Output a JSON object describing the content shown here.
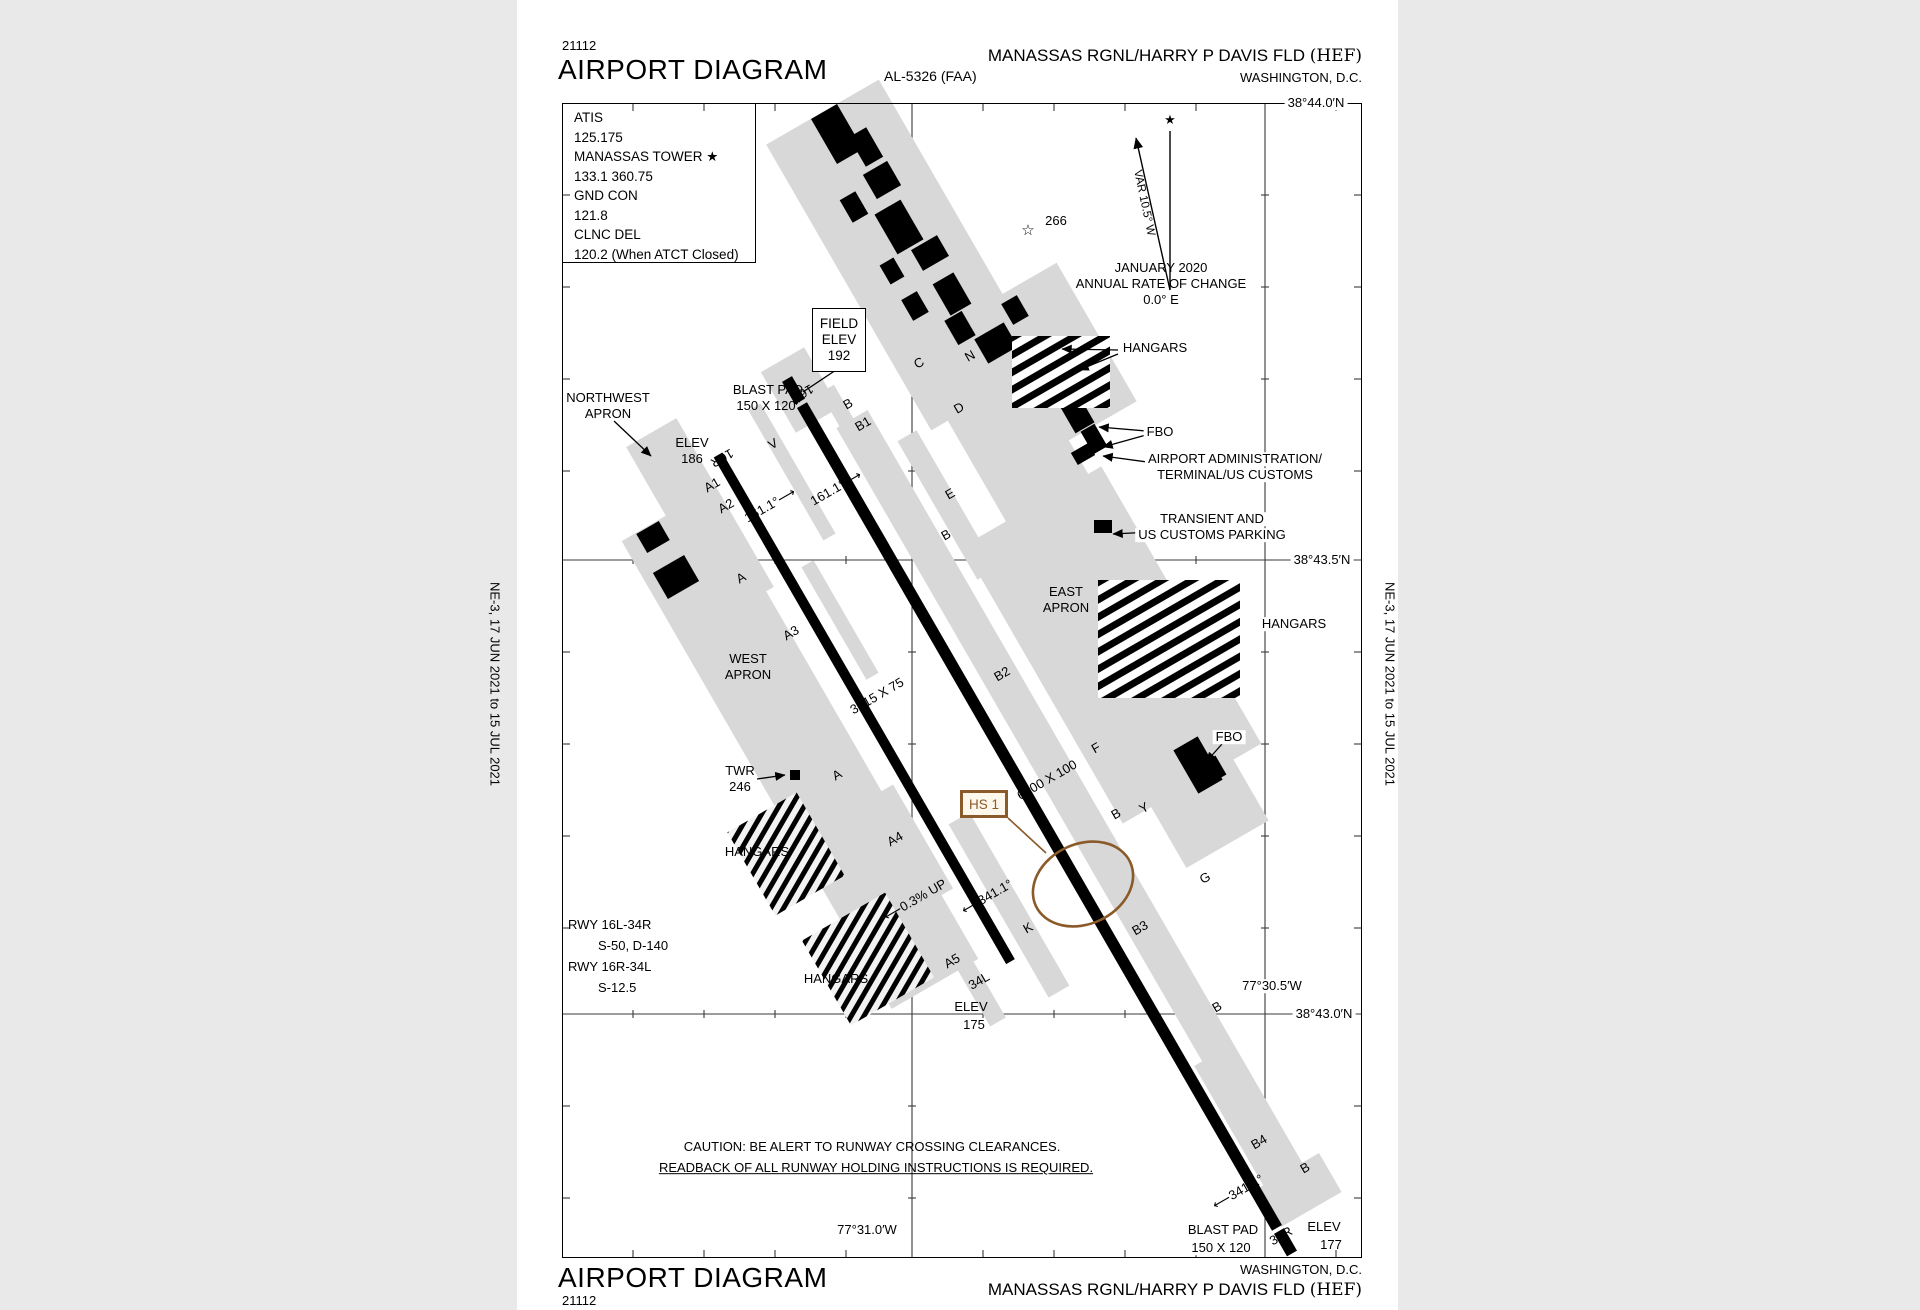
{
  "header": {
    "chart_id": "21112",
    "title": "AIRPORT DIAGRAM",
    "procedure_id": "AL-5326 (FAA)",
    "airport_name": "MANASSAS RGNL/HARRY P DAVIS FLD ",
    "airport_code": "(HEF)",
    "city": "WASHINGTON, D.C."
  },
  "footer": {
    "chart_id": "21112",
    "title": "AIRPORT DIAGRAM",
    "airport_name": "MANASSAS RGNL/HARRY P DAVIS FLD ",
    "airport_code": "(HEF)",
    "city": "WASHINGTON, D.C."
  },
  "margins": {
    "left_note": "NE-3,  17 JUN 2021  to  15 JUL 2021",
    "right_note": "NE-3,  17 JUN 2021  to  15 JUL 2021"
  },
  "comm_box": {
    "lines": [
      "ATIS",
      "125.175",
      "MANASSAS TOWER ★",
      "133.1  360.75",
      "GND CON",
      "121.8",
      "CLNC DEL",
      "120.2 (When ATCT Closed)"
    ]
  },
  "field_elev_box": {
    "lines": [
      "FIELD",
      "ELEV",
      "192"
    ]
  },
  "hot_spot": {
    "label": "HS 1"
  },
  "colors": {
    "hotspot_brown": "#8a5a2a",
    "apron_gray": "#d8d8d8",
    "ink": "#000000",
    "page": "#ffffff"
  },
  "labels": [
    {
      "n": "lat-label-44-0",
      "t": "38°44.0′N",
      "x": 1316,
      "y": 103,
      "cls": "bg"
    },
    {
      "n": "lat-label-43-5",
      "t": "38°43.5′N",
      "x": 1322,
      "y": 560,
      "cls": "bg"
    },
    {
      "n": "lat-label-43-0",
      "t": "38°43.0′N",
      "x": 1324,
      "y": 1014,
      "cls": "bg"
    },
    {
      "n": "lon-label-30-5",
      "t": "77°30.5′W",
      "x": 1272,
      "y": 986,
      "cls": "bg"
    },
    {
      "n": "lon-label-31-0",
      "t": "77°31.0′W",
      "x": 867,
      "y": 1230,
      "cls": "bg"
    },
    {
      "n": "magvar-date",
      "t": "JANUARY 2020",
      "x": 1161,
      "y": 268
    },
    {
      "n": "magvar-rate-1",
      "t": "ANNUAL RATE OF CHANGE",
      "x": 1161,
      "y": 284
    },
    {
      "n": "magvar-rate-2",
      "t": "0.0° E",
      "x": 1161,
      "y": 300
    },
    {
      "n": "beacon-star-icon",
      "t": "☆",
      "x": 1028,
      "y": 231,
      "fs": 15
    },
    {
      "n": "beacon-elev",
      "t": "266",
      "x": 1056,
      "y": 221
    },
    {
      "n": "hangars-north-label",
      "t": "HANGARS",
      "x": 1155,
      "y": 348,
      "cls": "bg"
    },
    {
      "n": "fbo-north-label",
      "t": "FBO",
      "x": 1160,
      "y": 432,
      "cls": "bg"
    },
    {
      "n": "admin-label-1",
      "t": "AIRPORT ADMINISTRATION/",
      "x": 1235,
      "y": 459,
      "cls": "bg"
    },
    {
      "n": "admin-label-2",
      "t": "TERMINAL/US CUSTOMS",
      "x": 1235,
      "y": 475,
      "cls": "bg"
    },
    {
      "n": "transient-label-1",
      "t": "TRANSIENT AND",
      "x": 1212,
      "y": 519,
      "cls": "bg"
    },
    {
      "n": "transient-label-2",
      "t": "US CUSTOMS PARKING",
      "x": 1212,
      "y": 535,
      "cls": "bg"
    },
    {
      "n": "east-apron-label-1",
      "t": "EAST",
      "x": 1066,
      "y": 592
    },
    {
      "n": "east-apron-label-2",
      "t": "APRON",
      "x": 1066,
      "y": 608
    },
    {
      "n": "hangars-east-label",
      "t": "HANGARS",
      "x": 1294,
      "y": 624,
      "cls": "bg"
    },
    {
      "n": "fbo-south-label",
      "t": "FBO",
      "x": 1229,
      "y": 737,
      "cls": "bg"
    },
    {
      "n": "northwest-apron-label-1",
      "t": "NORTHWEST",
      "x": 608,
      "y": 398
    },
    {
      "n": "northwest-apron-label-2",
      "t": "APRON",
      "x": 608,
      "y": 414
    },
    {
      "n": "elev-186-label-1",
      "t": "ELEV",
      "x": 692,
      "y": 443
    },
    {
      "n": "elev-186-label-2",
      "t": "186",
      "x": 692,
      "y": 459
    },
    {
      "n": "blastpad-north-label-1",
      "t": "BLAST PAD",
      "x": 768,
      "y": 390
    },
    {
      "n": "blastpad-north-label-2",
      "t": "150 X 120",
      "x": 766,
      "y": 406
    },
    {
      "n": "west-apron-label-1",
      "t": "WEST",
      "x": 748,
      "y": 659
    },
    {
      "n": "west-apron-label-2",
      "t": "APRON",
      "x": 748,
      "y": 675
    },
    {
      "n": "tower-label-1",
      "t": "TWR",
      "x": 740,
      "y": 771
    },
    {
      "n": "tower-label-2",
      "t": "246",
      "x": 740,
      "y": 787
    },
    {
      "n": "hangars-west-label",
      "t": "HANGARS",
      "x": 757,
      "y": 852
    },
    {
      "n": "hangars-southwest-label",
      "t": "HANGARS",
      "x": 836,
      "y": 979
    },
    {
      "n": "rwy-data-1",
      "t": "RWY 16L-34R",
      "x": 568,
      "y": 925,
      "cls": "left"
    },
    {
      "n": "rwy-data-2",
      "t": "S-50, D-140",
      "x": 598,
      "y": 946,
      "cls": "left"
    },
    {
      "n": "rwy-data-3",
      "t": "RWY 16R-34L",
      "x": 568,
      "y": 967,
      "cls": "left"
    },
    {
      "n": "rwy-data-4",
      "t": "S-12.5",
      "x": 598,
      "y": 988,
      "cls": "left"
    },
    {
      "n": "caution-line-1",
      "t": "CAUTION: BE ALERT TO RUNWAY CROSSING CLEARANCES.",
      "x": 872,
      "y": 1147
    },
    {
      "n": "caution-line-2",
      "t": "READBACK OF ALL RUNWAY HOLDING INSTRUCTIONS IS REQUIRED.",
      "x": 876,
      "y": 1168,
      "cls": "ul"
    },
    {
      "n": "blastpad-south-label-1",
      "t": "BLAST PAD",
      "x": 1223,
      "y": 1230,
      "cls": "bg"
    },
    {
      "n": "blastpad-south-label-2",
      "t": "150 X 120",
      "x": 1221,
      "y": 1248,
      "cls": "bg"
    },
    {
      "n": "elev-177-label-1",
      "t": "ELEV",
      "x": 1324,
      "y": 1227
    },
    {
      "n": "elev-177-label-2",
      "t": "177",
      "x": 1331,
      "y": 1245
    },
    {
      "n": "elev-175-label-1",
      "t": "ELEV",
      "x": 971,
      "y": 1007
    },
    {
      "n": "elev-175-label-2",
      "t": "175",
      "x": 974,
      "y": 1025
    },
    {
      "n": "rwy-16l-number",
      "t": "16L",
      "x": 803,
      "y": 393,
      "rot": 150
    },
    {
      "n": "rwy-16r-number",
      "t": "16R",
      "x": 722,
      "y": 458,
      "rot": 150
    },
    {
      "n": "rwy-34l-number",
      "t": "34L",
      "x": 979,
      "y": 981,
      "rot": -30
    },
    {
      "n": "rwy-34r-number",
      "t": "34R",
      "x": 1281,
      "y": 1236,
      "rot": -30
    },
    {
      "n": "rwy-heading-161-west",
      "t": "161.1°⟶",
      "x": 770,
      "y": 505,
      "rot": -30
    },
    {
      "n": "rwy-heading-161-east",
      "t": "161.1°⟶",
      "x": 836,
      "y": 488,
      "rot": -30
    },
    {
      "n": "rwy-heading-341-east",
      "t": "⟵341.1°",
      "x": 1238,
      "y": 1192,
      "rot": -30
    },
    {
      "n": "rwy-heading-341-west",
      "t": "⟵341.1°",
      "x": 987,
      "y": 897,
      "rot": -30
    },
    {
      "n": "rwy-gradient",
      "t": "⟵0.3% UP",
      "x": 915,
      "y": 900,
      "rot": -30
    },
    {
      "n": "rwy-16r-dimensions",
      "t": "3715 X 75",
      "x": 877,
      "y": 696,
      "rot": -30
    },
    {
      "n": "rwy-16l-dimensions",
      "t": "6200 X 100",
      "x": 1047,
      "y": 780,
      "rot": -30
    },
    {
      "n": "taxiway-a-label-1",
      "t": "A",
      "x": 741,
      "y": 578,
      "rot": -30
    },
    {
      "n": "taxiway-a-label-2",
      "t": "A",
      "x": 837,
      "y": 775,
      "rot": -30
    },
    {
      "n": "taxiway-a1-label",
      "t": "A1",
      "x": 712,
      "y": 485,
      "rot": -30
    },
    {
      "n": "taxiway-a2-label",
      "t": "A2",
      "x": 726,
      "y": 506,
      "rot": -30
    },
    {
      "n": "taxiway-a3-label",
      "t": "A3",
      "x": 791,
      "y": 633,
      "rot": -30
    },
    {
      "n": "taxiway-a4-label",
      "t": "A4",
      "x": 895,
      "y": 839,
      "rot": -30
    },
    {
      "n": "taxiway-a5-label",
      "t": "A5",
      "x": 952,
      "y": 961,
      "rot": -30
    },
    {
      "n": "taxiway-b-label-1",
      "t": "B",
      "x": 848,
      "y": 404,
      "rot": -30
    },
    {
      "n": "taxiway-b-label-2",
      "t": "B",
      "x": 946,
      "y": 535,
      "rot": -30
    },
    {
      "n": "taxiway-b-label-3",
      "t": "B",
      "x": 1116,
      "y": 814,
      "rot": -30
    },
    {
      "n": "taxiway-b-label-4",
      "t": "B",
      "x": 1217,
      "y": 1007,
      "rot": -30
    },
    {
      "n": "taxiway-b-label-5",
      "t": "B",
      "x": 1305,
      "y": 1168,
      "rot": -30
    },
    {
      "n": "taxiway-b1-label",
      "t": "B1",
      "x": 863,
      "y": 424,
      "rot": -30
    },
    {
      "n": "taxiway-b2-label",
      "t": "B2",
      "x": 1002,
      "y": 674,
      "rot": -30
    },
    {
      "n": "taxiway-b3-label",
      "t": "B3",
      "x": 1140,
      "y": 928,
      "rot": -30
    },
    {
      "n": "taxiway-b4-label",
      "t": "B4",
      "x": 1259,
      "y": 1142,
      "rot": -30
    },
    {
      "n": "taxiway-c-label",
      "t": "C",
      "x": 919,
      "y": 363,
      "rot": -30
    },
    {
      "n": "taxiway-d-label",
      "t": "D",
      "x": 959,
      "y": 408,
      "rot": -30
    },
    {
      "n": "taxiway-e-label",
      "t": "E",
      "x": 950,
      "y": 494,
      "rot": -30
    },
    {
      "n": "taxiway-f-label",
      "t": "F",
      "x": 1096,
      "y": 748,
      "rot": -30
    },
    {
      "n": "taxiway-g-label",
      "t": "G",
      "x": 1205,
      "y": 878,
      "rot": -30
    },
    {
      "n": "taxiway-k-label",
      "t": "K",
      "x": 1028,
      "y": 928,
      "rot": -30
    },
    {
      "n": "taxiway-n-label-1",
      "t": "N",
      "x": 896,
      "y": 230,
      "rot": -30
    },
    {
      "n": "taxiway-n-label-2",
      "t": "N",
      "x": 970,
      "y": 356,
      "rot": -30
    },
    {
      "n": "taxiway-v-label",
      "t": "V",
      "x": 773,
      "y": 444,
      "rot": -30
    },
    {
      "n": "taxiway-y-label",
      "t": "Y",
      "x": 1144,
      "y": 808,
      "rot": -30
    },
    {
      "n": "var-label",
      "t": "VAR 10.5° W",
      "x": 1144,
      "y": 203,
      "rot": 78,
      "fs": 11.5
    },
    {
      "n": "true-north-star-icon",
      "t": "★",
      "x": 1170,
      "y": 120,
      "fs": 13
    }
  ]
}
